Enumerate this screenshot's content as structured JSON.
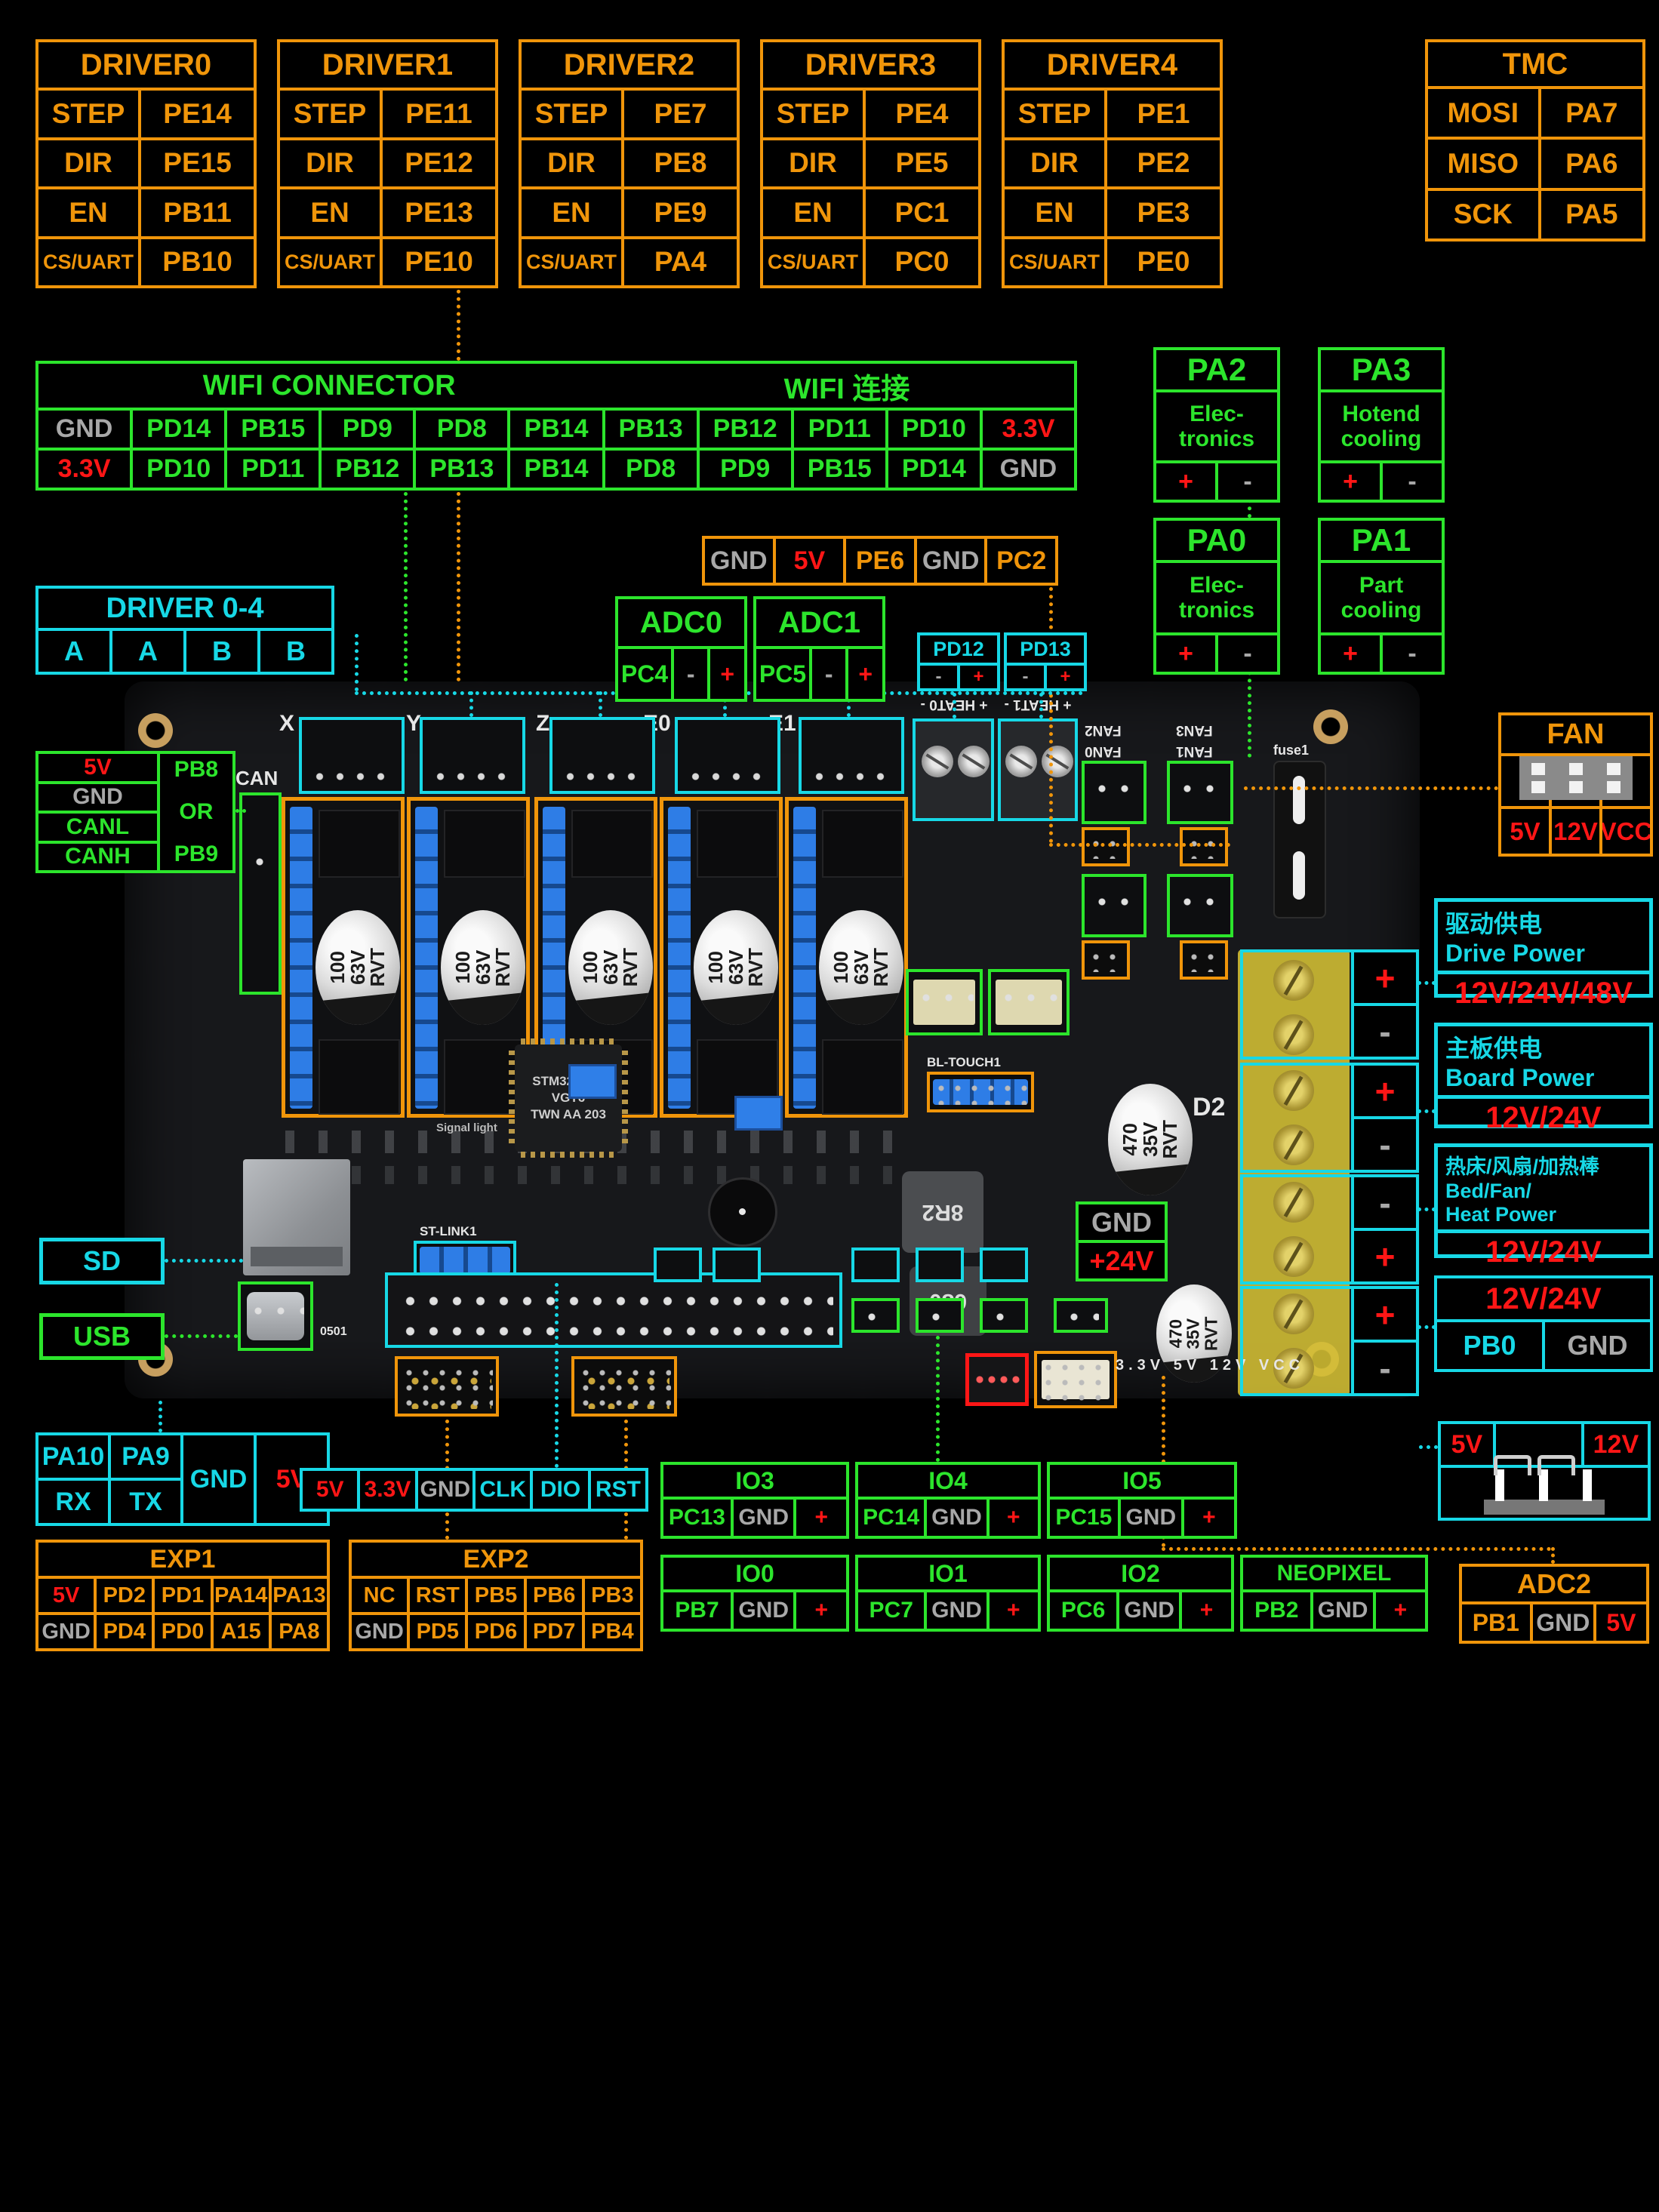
{
  "palette": {
    "orange": "#f0950a",
    "green": "#2ce52c",
    "cyan": "#17d8e6",
    "red": "#ff1616",
    "gray": "#a8a8a8"
  },
  "drivers": [
    {
      "title": "DRIVER0",
      "cells": [
        "STEP",
        "PE14",
        "DIR",
        "PE15",
        "EN",
        "PB11",
        "CS/UART",
        "PB10"
      ]
    },
    {
      "title": "DRIVER1",
      "cells": [
        "STEP",
        "PE11",
        "DIR",
        "PE12",
        "EN",
        "PE13",
        "CS/UART",
        "PE10"
      ]
    },
    {
      "title": "DRIVER2",
      "cells": [
        "STEP",
        "PE7",
        "DIR",
        "PE8",
        "EN",
        "PE9",
        "CS/UART",
        "PA4"
      ]
    },
    {
      "title": "DRIVER3",
      "cells": [
        "STEP",
        "PE4",
        "DIR",
        "PE5",
        "EN",
        "PC1",
        "CS/UART",
        "PC0"
      ]
    },
    {
      "title": "DRIVER4",
      "cells": [
        "STEP",
        "PE1",
        "DIR",
        "PE2",
        "EN",
        "PE3",
        "CS/UART",
        "PE0"
      ]
    }
  ],
  "tmc": {
    "title": "TMC",
    "cells": [
      "MOSI",
      "PA7",
      "MISO",
      "PA6",
      "SCK",
      "PA5"
    ]
  },
  "wifi": {
    "title_left": "WIFI CONNECTOR",
    "title_right": "WIFI 连接",
    "row1": [
      {
        "t": "GND",
        "c": "gray"
      },
      "PD14",
      "PB15",
      "PD9",
      "PD8",
      "PB14",
      "PB13",
      "PB12",
      "PD11",
      "PD10",
      {
        "t": "3.3V",
        "c": "red"
      }
    ],
    "row2": [
      {
        "t": "3.3V",
        "c": "red"
      },
      "PD10",
      "PD11",
      "PB12",
      "PB13",
      "PB14",
      "PD8",
      "PD9",
      "PB15",
      "PD14",
      {
        "t": "GND",
        "c": "gray"
      }
    ]
  },
  "pa_boxes": [
    {
      "title": "PA2",
      "line1": "Elec-",
      "line2": "tronics"
    },
    {
      "title": "PA3",
      "line1": "Hotend",
      "line2": "cooling"
    },
    {
      "title": "PA0",
      "line1": "Elec-",
      "line2": "tronics"
    },
    {
      "title": "PA1",
      "line1": "Part",
      "line2": "cooling"
    }
  ],
  "pm": {
    "plus": "+",
    "minus": "-"
  },
  "aux_header": {
    "cells": [
      {
        "t": "GND",
        "c": "gray"
      },
      {
        "t": "5V",
        "c": "red"
      },
      "PE6",
      {
        "t": "GND",
        "c": "gray"
      },
      "PC2"
    ]
  },
  "adc0": {
    "title": "ADC0",
    "cells": [
      "PC4",
      {
        "t": "-",
        "c": "gray"
      },
      {
        "t": "+",
        "c": "red"
      }
    ]
  },
  "adc1": {
    "title": "ADC1",
    "cells": [
      "PC5",
      {
        "t": "-",
        "c": "gray"
      },
      {
        "t": "+",
        "c": "red"
      }
    ]
  },
  "pd12": {
    "title": "PD12"
  },
  "pd13": {
    "title": "PD13"
  },
  "driver04": {
    "title": "DRIVER 0-4",
    "cells": [
      "A",
      "A",
      "B",
      "B"
    ]
  },
  "can": {
    "left": [
      {
        "t": "5V",
        "c": "red"
      },
      {
        "t": "GND",
        "c": "gray"
      },
      "CANL",
      "CANH"
    ],
    "pb8": "PB8",
    "or": "OR",
    "pb9": "PB9"
  },
  "fan": {
    "title": "FAN",
    "cells": [
      {
        "t": "5V",
        "c": "red"
      },
      {
        "t": "12V",
        "c": "red"
      },
      {
        "t": "VCC",
        "c": "red"
      }
    ]
  },
  "power": [
    {
      "line1": "驱动供电",
      "line2": "Drive Power",
      "volt": "12V/24V/48V"
    },
    {
      "line1": "主板供电",
      "line2": "Board Power",
      "volt": "12V/24V"
    },
    {
      "line1": "热床/风扇/加热棒",
      "line2": "Bed/Fan/",
      "line3": "Heat Power",
      "volt": "12V/24V"
    }
  ],
  "pb0_table": {
    "header": "12V/24V",
    "pb0": "PB0",
    "gnd": "GND"
  },
  "jumper_table": {
    "v5": "5V",
    "v12": "12V"
  },
  "adc2": {
    "title": "ADC2",
    "cells": [
      "PB1",
      {
        "t": "GND",
        "c": "gray"
      },
      {
        "t": "5V",
        "c": "red"
      }
    ]
  },
  "sd_label": "SD",
  "usb_label": "USB",
  "serial": {
    "pa10": "PA10",
    "pa9": "PA9",
    "rx": "RX",
    "tx": "TX",
    "gnd": "GND",
    "v5": "5V"
  },
  "exp1": {
    "title": "EXP1",
    "cells": [
      {
        "t": "5V",
        "c": "red"
      },
      "PD2",
      "PD1",
      "PA14",
      "PA13",
      {
        "t": "GND",
        "c": "gray"
      },
      "PD4",
      "PD0",
      "A15",
      "PA8"
    ]
  },
  "exp2": {
    "title": "EXP2",
    "cells": [
      "NC",
      "RST",
      "PB5",
      "PB6",
      "PB3",
      {
        "t": "GND",
        "c": "gray"
      },
      "PD5",
      "PD6",
      "PD7",
      "PB4"
    ]
  },
  "swd_row": {
    "cells": [
      {
        "t": "5V",
        "c": "red"
      },
      {
        "t": "3.3V",
        "c": "red"
      },
      {
        "t": "GND",
        "c": "gray"
      },
      "CLK",
      "DIO",
      "RST"
    ]
  },
  "io_tables": [
    {
      "title": "IO3",
      "cells": [
        "PC13",
        {
          "t": "GND",
          "c": "gray"
        },
        {
          "t": "+",
          "c": "red"
        }
      ]
    },
    {
      "title": "IO4",
      "cells": [
        "PC14",
        {
          "t": "GND",
          "c": "gray"
        },
        {
          "t": "+",
          "c": "red"
        }
      ]
    },
    {
      "title": "IO5",
      "cells": [
        "PC15",
        {
          "t": "GND",
          "c": "gray"
        },
        {
          "t": "+",
          "c": "red"
        }
      ]
    },
    {
      "title": "IO0",
      "cells": [
        "PB7",
        {
          "t": "GND",
          "c": "gray"
        },
        {
          "t": "+",
          "c": "red"
        }
      ]
    },
    {
      "title": "IO1",
      "cells": [
        "PC7",
        {
          "t": "GND",
          "c": "gray"
        },
        {
          "t": "+",
          "c": "red"
        }
      ]
    },
    {
      "title": "IO2",
      "cells": [
        "PC6",
        {
          "t": "GND",
          "c": "gray"
        },
        {
          "t": "+",
          "c": "red"
        }
      ]
    },
    {
      "title": "NEOPIXEL",
      "cells": [
        "PB2",
        {
          "t": "GND",
          "c": "gray"
        },
        {
          "t": "+",
          "c": "red"
        }
      ]
    }
  ],
  "board": {
    "motors": [
      "X",
      "Y",
      "Z",
      "E0",
      "E1"
    ],
    "can_label": "CAN",
    "cap_lines": [
      "100",
      "63V",
      "RVT"
    ],
    "cap2_lines": [
      "470",
      "35V",
      "RVT"
    ],
    "heat_labels": [
      "+ HEAT0 -",
      "+ HEAT1 -"
    ],
    "fan_labels": [
      "FAN2",
      "FAN3",
      "FAN0",
      "FAN1"
    ],
    "fuse_label": "fuse1",
    "d2": "D2",
    "power24": {
      "gnd": "GND",
      "v24": "+24V"
    },
    "chip_lines": [
      "STM32H723",
      "VGT6",
      "TWN AA 203"
    ],
    "stlink": "ST-LINK1",
    "bltouch": "BL-TOUCH1",
    "ind1": "8R2",
    "ind2": "680",
    "rail": "3.3V 5V 12V VCC",
    "usb_code": "0501",
    "signal": "Signal light",
    "terminal_pm": [
      [
        "+",
        "-"
      ],
      [
        "+",
        "-"
      ],
      [
        "-",
        "+"
      ],
      [
        "+",
        "-"
      ]
    ]
  }
}
